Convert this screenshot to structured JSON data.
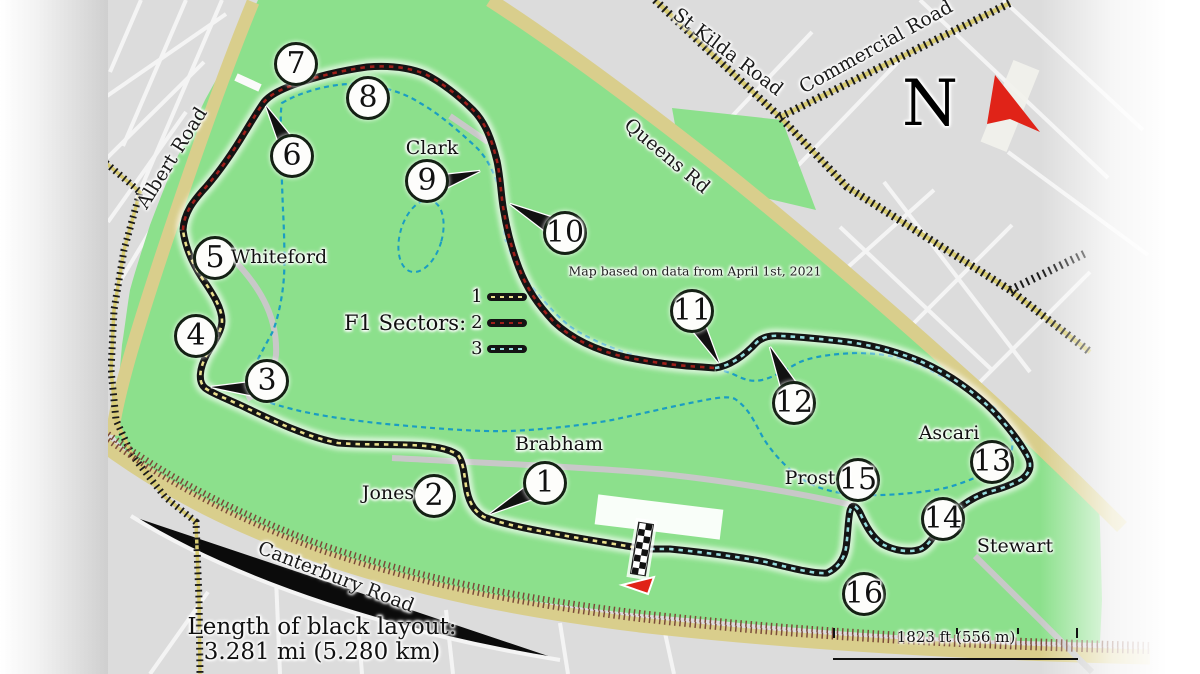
{
  "map": {
    "note": "Map based on data from April 1st, 2021",
    "compass_letter": "N",
    "legend": {
      "label": "F1 Sectors:",
      "sectors": [
        {
          "num": "1",
          "dash_color": "#EADF8C"
        },
        {
          "num": "2",
          "dash_color": "#9E1F1A"
        },
        {
          "num": "3",
          "dash_color": "#96DCDE"
        }
      ]
    },
    "length_note": {
      "line1": "Length of black layout:",
      "line2": "3.281 mi (5.280 km)"
    },
    "scale_label": "1823 ft (556 m)",
    "corners": [
      {
        "num": "1",
        "x": 545,
        "y": 483
      },
      {
        "num": "2",
        "x": 434,
        "y": 496
      },
      {
        "num": "3",
        "x": 267,
        "y": 381
      },
      {
        "num": "4",
        "x": 196,
        "y": 336
      },
      {
        "num": "5",
        "x": 215,
        "y": 258
      },
      {
        "num": "6",
        "x": 292,
        "y": 156
      },
      {
        "num": "7",
        "x": 296,
        "y": 64
      },
      {
        "num": "8",
        "x": 368,
        "y": 98
      },
      {
        "num": "9",
        "x": 427,
        "y": 181
      },
      {
        "num": "10",
        "x": 565,
        "y": 233
      },
      {
        "num": "11",
        "x": 692,
        "y": 311
      },
      {
        "num": "12",
        "x": 794,
        "y": 403
      },
      {
        "num": "13",
        "x": 992,
        "y": 462
      },
      {
        "num": "14",
        "x": 943,
        "y": 519
      },
      {
        "num": "15",
        "x": 858,
        "y": 480
      },
      {
        "num": "16",
        "x": 864,
        "y": 594
      }
    ],
    "corner_names": [
      {
        "name": "Whiteford",
        "x": 279,
        "y": 257
      },
      {
        "name": "Clark",
        "x": 432,
        "y": 148
      },
      {
        "name": "Jones",
        "x": 388,
        "y": 493
      },
      {
        "name": "Brabham",
        "x": 559,
        "y": 444
      },
      {
        "name": "Ascari",
        "x": 949,
        "y": 433
      },
      {
        "name": "Prost",
        "x": 810,
        "y": 478
      },
      {
        "name": "Stewart",
        "x": 1015,
        "y": 546
      }
    ],
    "road_labels": [
      {
        "name": "Albert Road",
        "x": 172,
        "y": 158,
        "rot": -58
      },
      {
        "name": "St Kilda Road",
        "x": 728,
        "y": 52,
        "rot": 37
      },
      {
        "name": "Commercial Road",
        "x": 876,
        "y": 47,
        "rot": -29
      },
      {
        "name": "Queens Rd",
        "x": 667,
        "y": 156,
        "rot": 40
      },
      {
        "name": "Canterbury Road",
        "x": 336,
        "y": 577,
        "rot": 21
      }
    ],
    "colors": {
      "park_green": "#8CE08C",
      "lake_blue": "#5ACBE9",
      "urban_gray": "#DCDCDC",
      "road_yellow": "#D9CE8C",
      "track_black": "#141414",
      "north_arrow_red": "#E02318"
    }
  }
}
